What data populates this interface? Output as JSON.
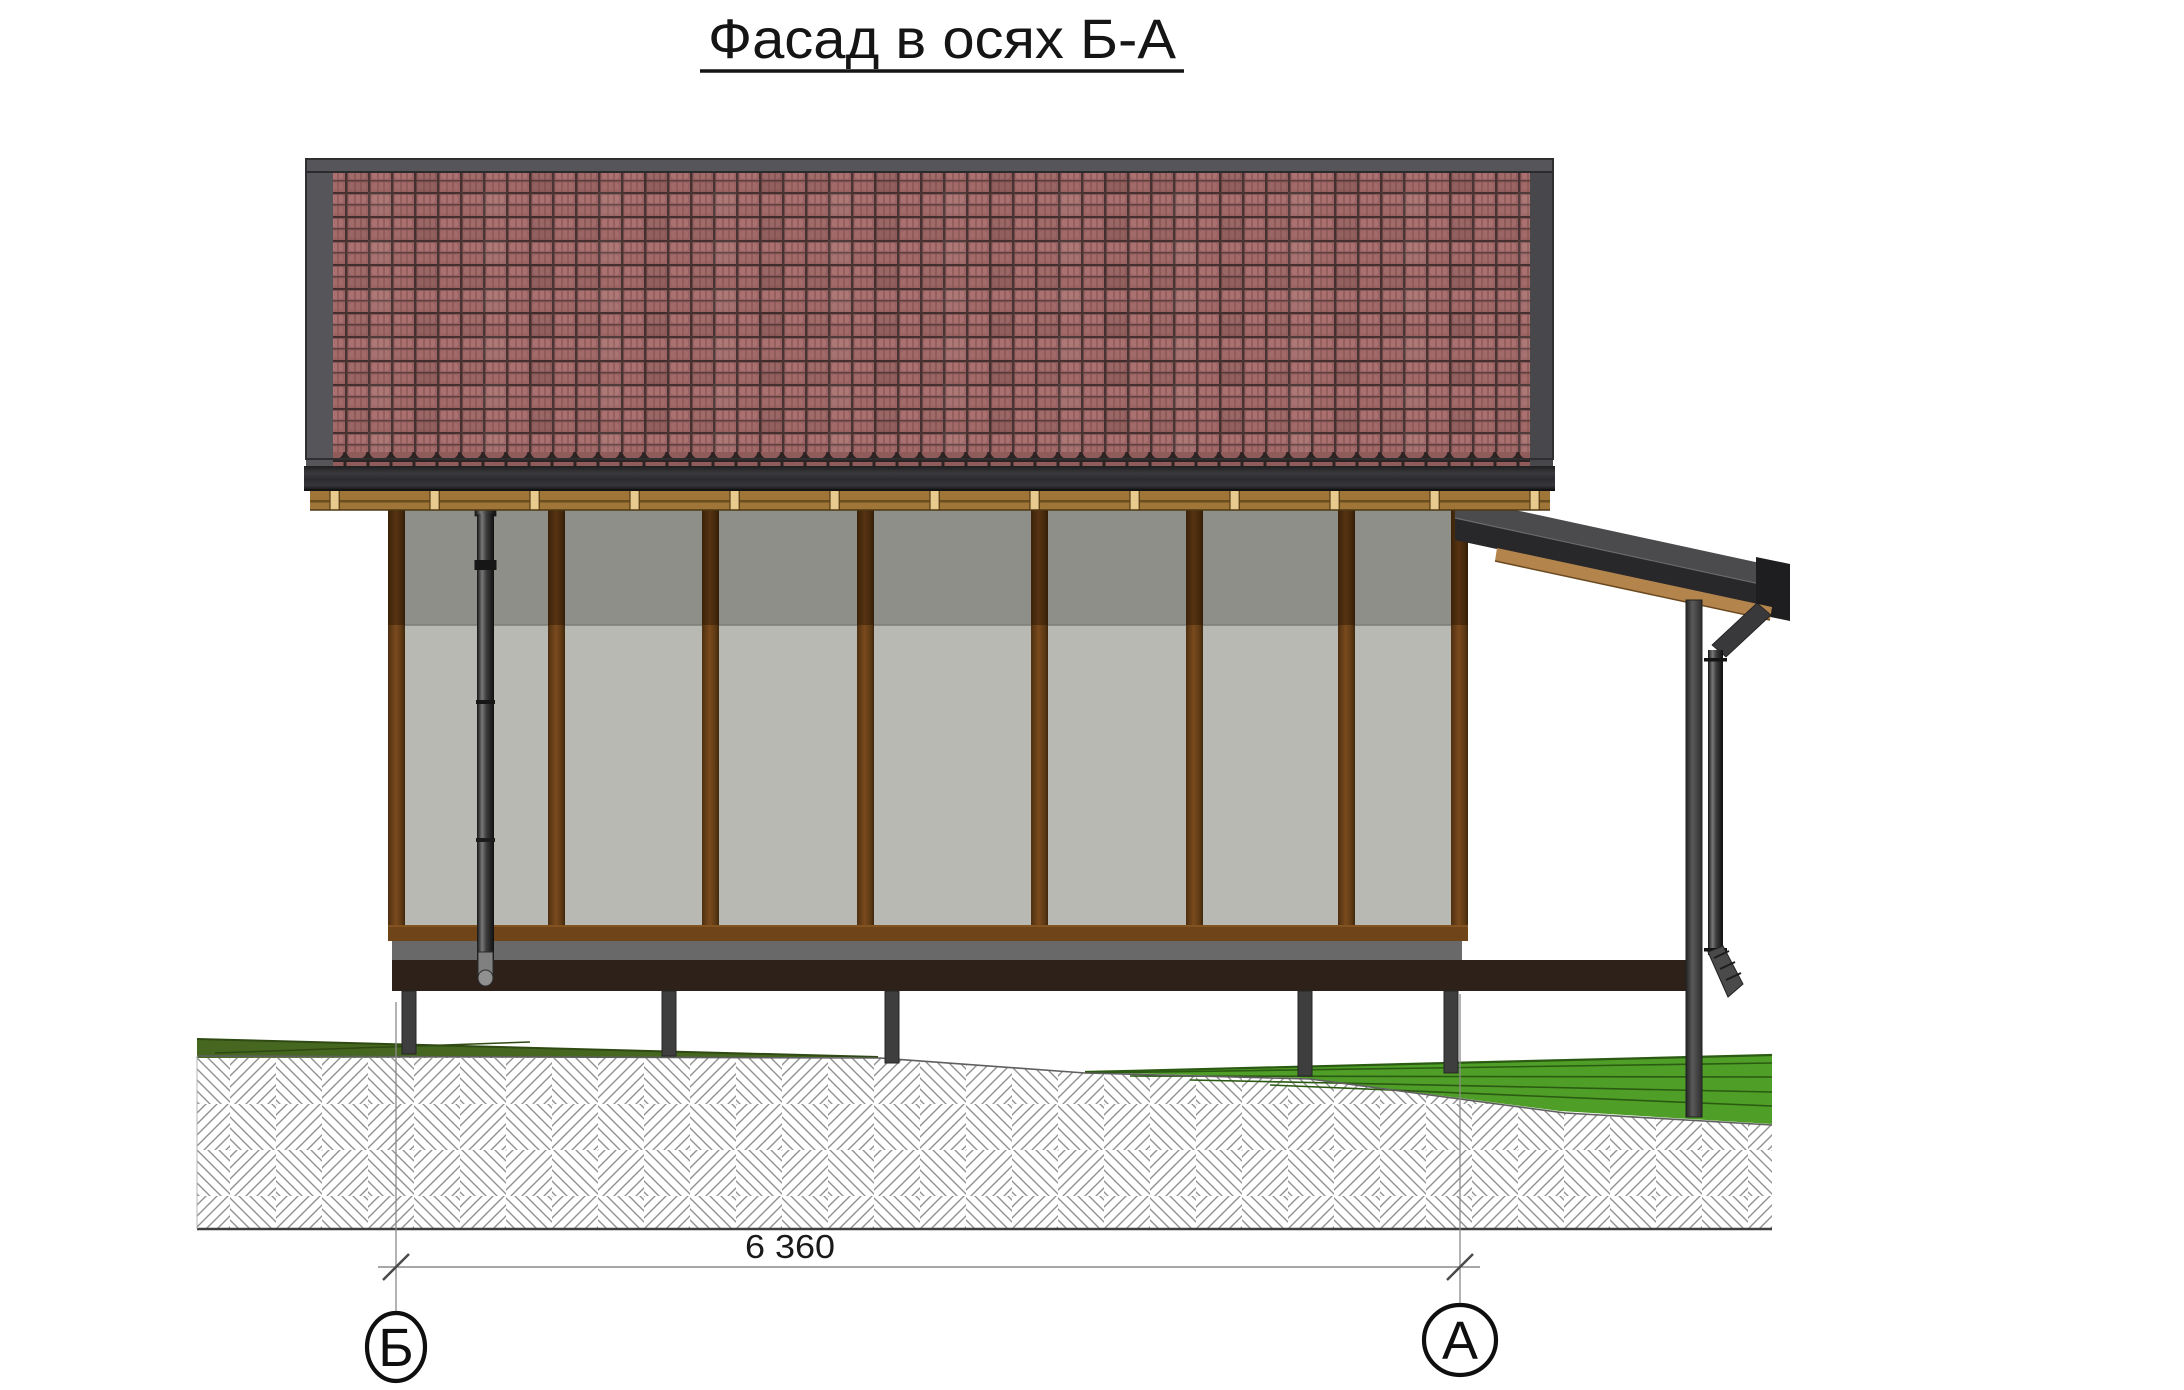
{
  "title": {
    "text": "Фасад в осях Б-А"
  },
  "dimension": {
    "label": "6 360"
  },
  "axes": {
    "left_label": "Б",
    "right_label": "А"
  },
  "colors": {
    "tile_red": "#9a6262",
    "tile_gap_dark": "#45302f",
    "roof_frame": "#56565a",
    "roof_frame_right": "#48484c",
    "fascia_dark": "#2c2c2f",
    "eave_wood": "#a07538",
    "eave_block": "#e8c98e",
    "wall_upper_gray": "#8f8f89",
    "wall_lower_gray": "#b9b9b3",
    "post_brown_dark": "#46290f",
    "post_brown": "#6f4419",
    "bottom_rail": "#6e4418",
    "deck_gray": "#696969",
    "deck_dark_brown": "#2e211a",
    "pile_gray": "#3e3e3e",
    "pipe_dark": "#141414",
    "pipe_light": "#787878",
    "porch_roof_dark": "#28282a",
    "porch_roof_light": "#4b4b4e",
    "porch_wood": "#b4844d",
    "grass_left_olive": "#45671f",
    "grass_right_green": "#4f9e27",
    "grass_line": "#2b5a12",
    "soil_hatch_line": "#909090",
    "drawing_line": "#8a8a8a",
    "ink": "#111111"
  }
}
